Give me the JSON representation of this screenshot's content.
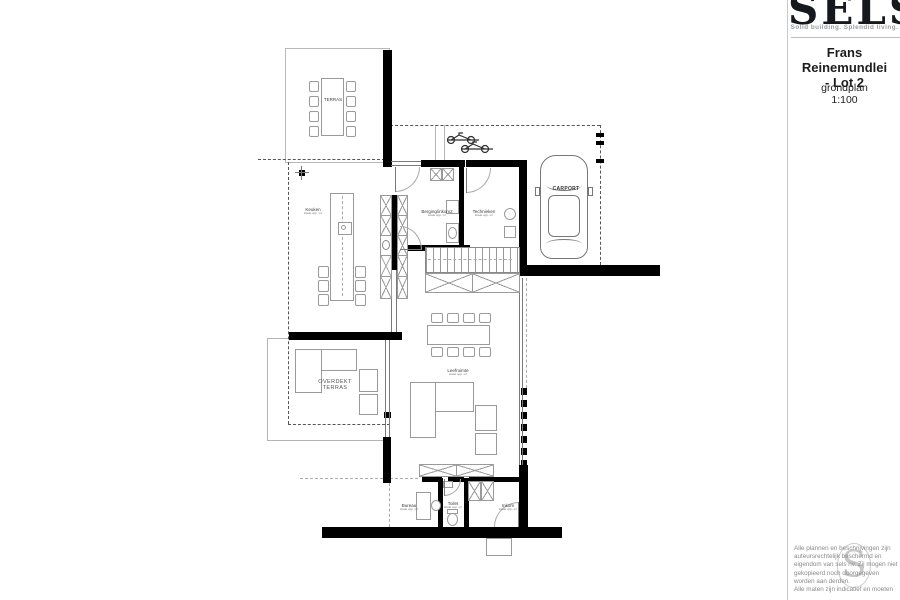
{
  "brand": {
    "logo_text": "SELS",
    "tagline": "Solid building. Splendid living."
  },
  "title_block": {
    "project_line1": "Frans Reinemundlei",
    "project_line2": "- Lot 2",
    "plan_type": "grondplan",
    "scale": "1:100",
    "watermark_letter": "S",
    "disclaimer": [
      "Alle plannen en beschrijvingen zijn",
      "auteursrechtelijk beschermd en",
      "eigendom van sels nv. Zij mogen niet",
      "gekopieerd noch doorgegeven",
      "worden aan derden.",
      "Alle maten zijn indicatief en moeten"
    ]
  },
  "plan": {
    "rooms": [
      {
        "name": "TERRAS",
        "area": ""
      },
      {
        "name": "Keuken",
        "area": "totale opp. m²"
      },
      {
        "name": "Berging/inkom2",
        "area": "totale opp. m²"
      },
      {
        "name": "Technieken",
        "area": "totale opp. m²"
      },
      {
        "name": "CARPORT",
        "area": ""
      },
      {
        "name": "Leefruimte",
        "area": "totale opp. m²"
      },
      {
        "name": "OVERDEKT",
        "name2": "TERRAS"
      },
      {
        "name": "Bureau",
        "area": "totale opp. m²"
      },
      {
        "name": "Toilet",
        "area": "totale opp. m²"
      },
      {
        "name": "Inkom",
        "area": "totale opp. m²"
      }
    ]
  }
}
